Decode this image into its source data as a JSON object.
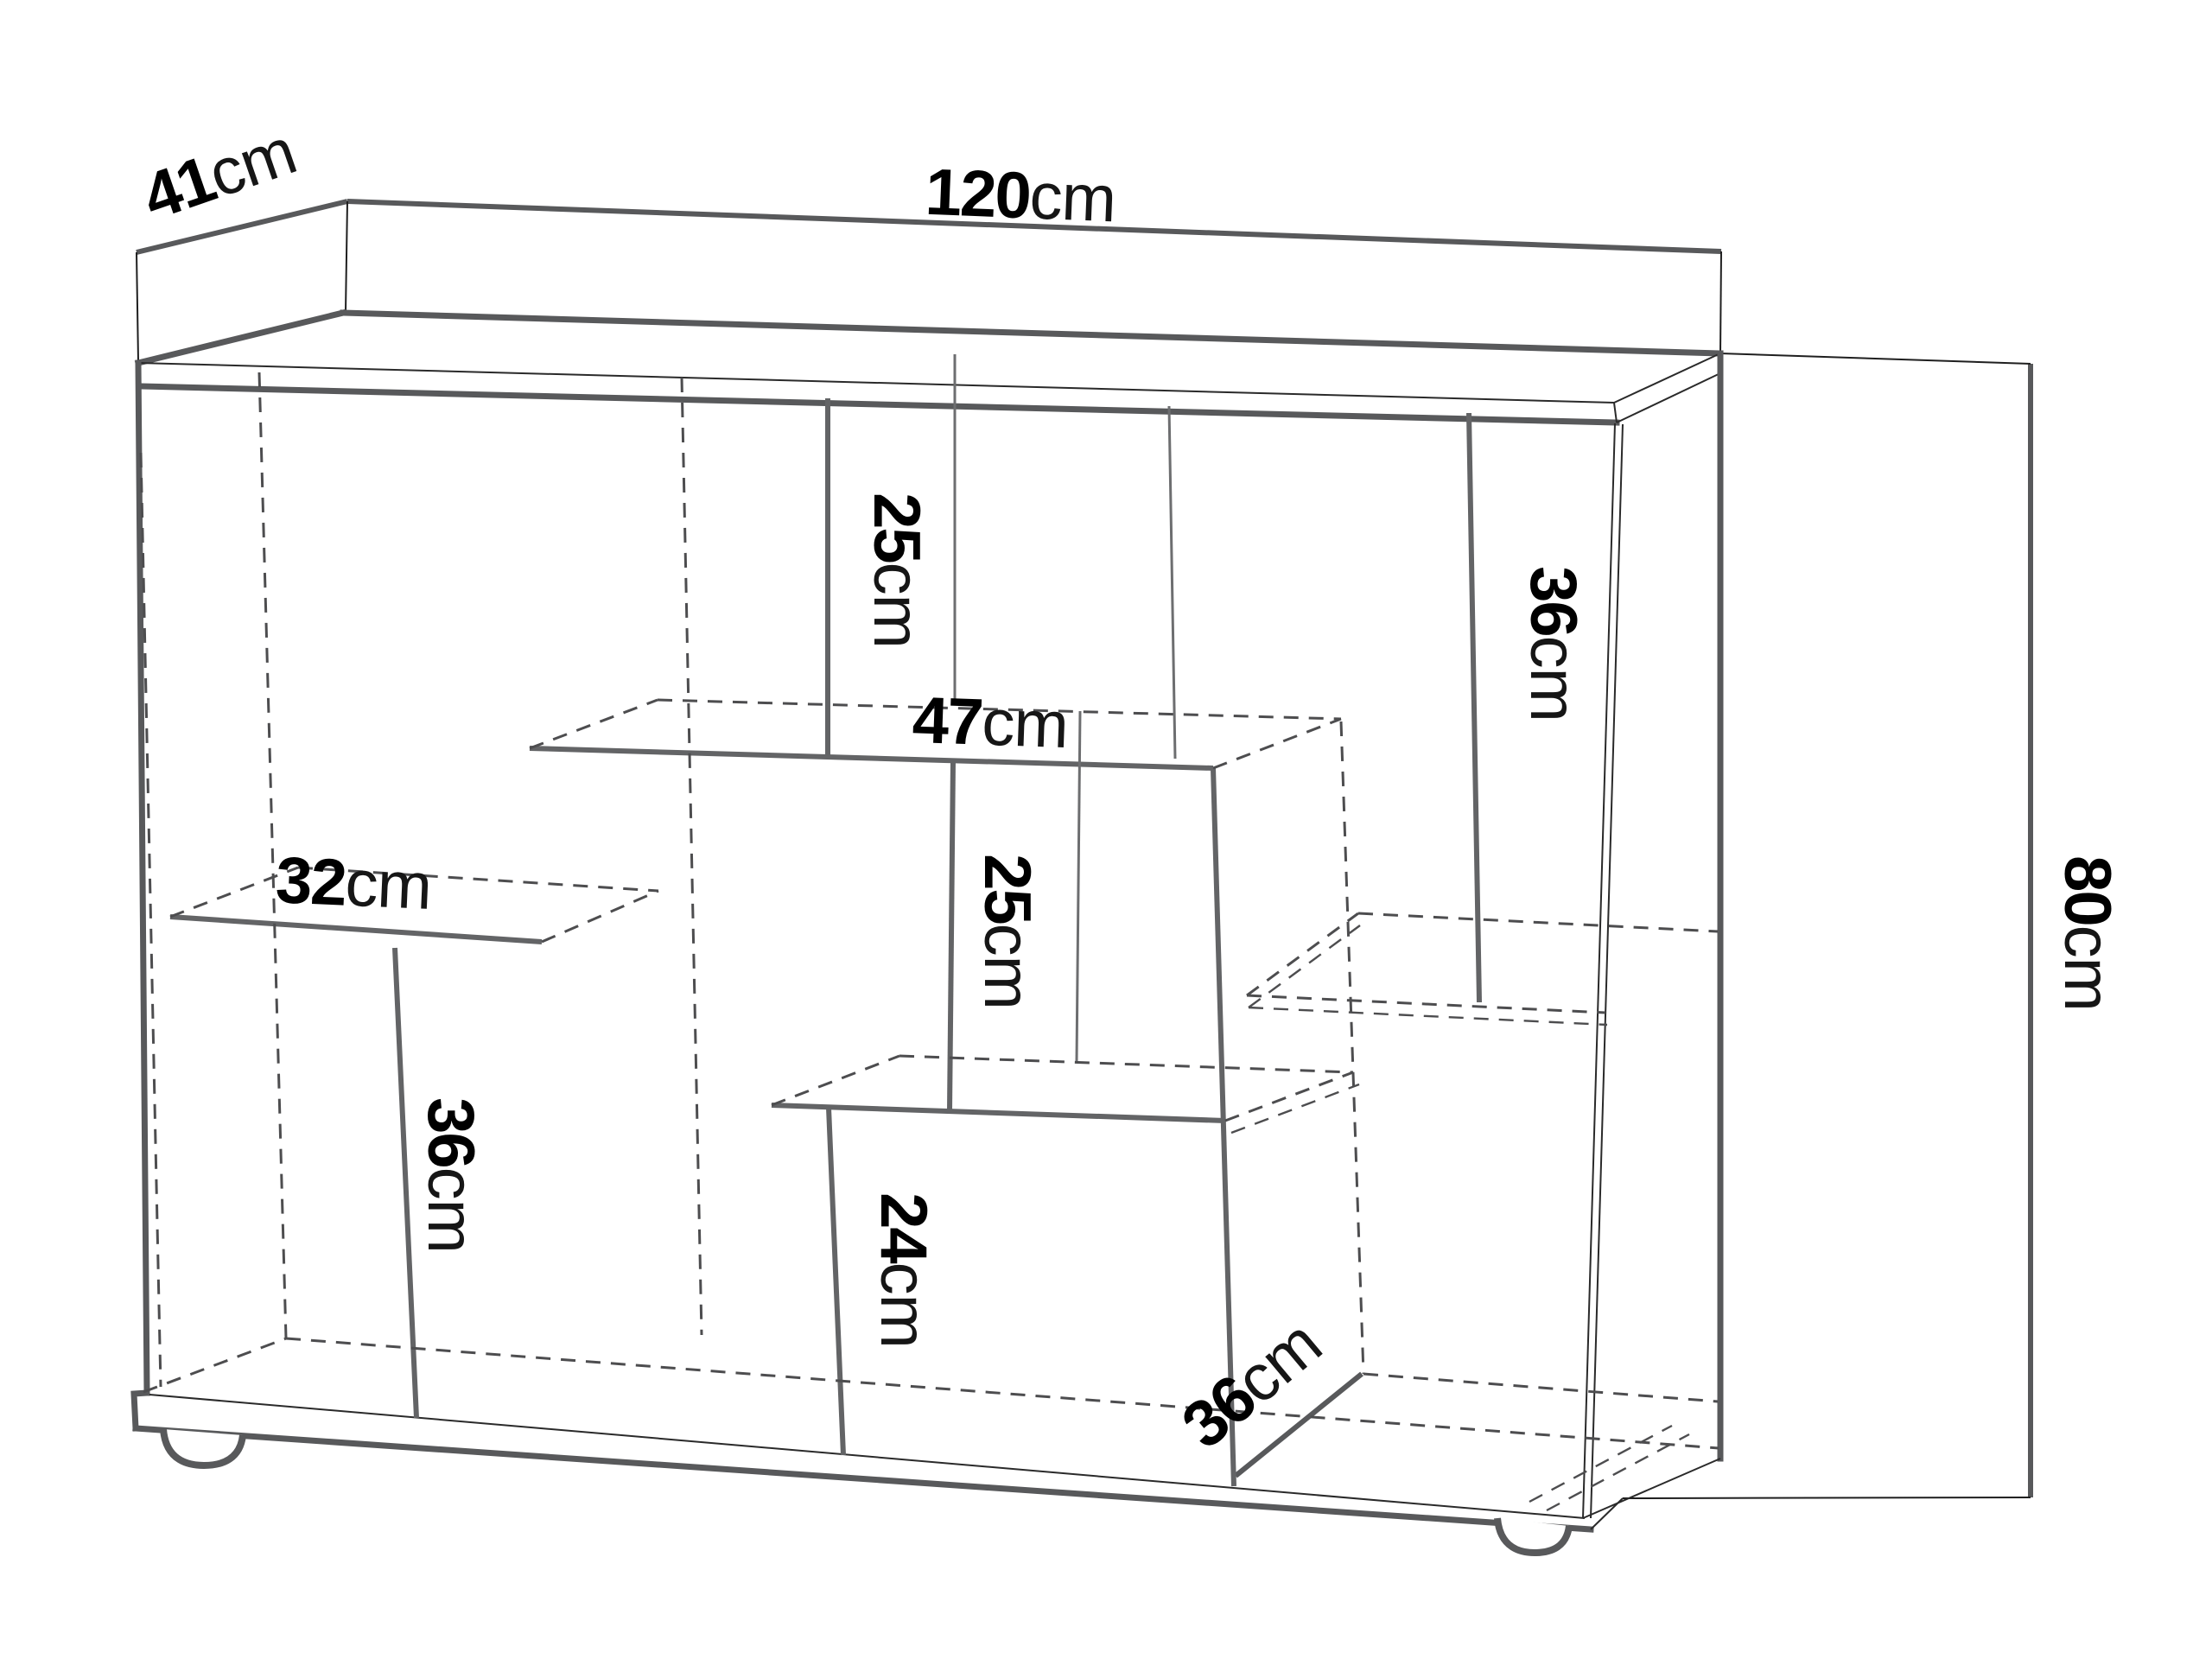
{
  "diagram": {
    "kind": "furniture-dimension-drawing",
    "unit_system": "cm"
  },
  "dimensions": {
    "width": {
      "value": "120",
      "unit": "cm"
    },
    "depth": {
      "value": "41",
      "unit": "cm"
    },
    "height": {
      "value": "80",
      "unit": "cm"
    },
    "top_center_compartment_height": {
      "value": "25",
      "unit": "cm"
    },
    "center_shelf_width": {
      "value": "47",
      "unit": "cm"
    },
    "middle_center_compartment_height": {
      "value": "25",
      "unit": "cm"
    },
    "bottom_center_compartment_height": {
      "value": "24",
      "unit": "cm"
    },
    "left_shelf_width": {
      "value": "32",
      "unit": "cm"
    },
    "bottom_left_compartment_height": {
      "value": "36",
      "unit": "cm"
    },
    "top_right_compartment_height": {
      "value": "36",
      "unit": "cm"
    },
    "bottom_right_compartment_depth": {
      "value": "36",
      "unit": "cm"
    }
  },
  "colors": {
    "background": "#ffffff",
    "outline_strong": "#58595b",
    "outline_thin": "#2a2a2a",
    "hidden_edge_dashed": "#4d4d4f",
    "label_number": "#000000",
    "label_unit": "#161616"
  }
}
